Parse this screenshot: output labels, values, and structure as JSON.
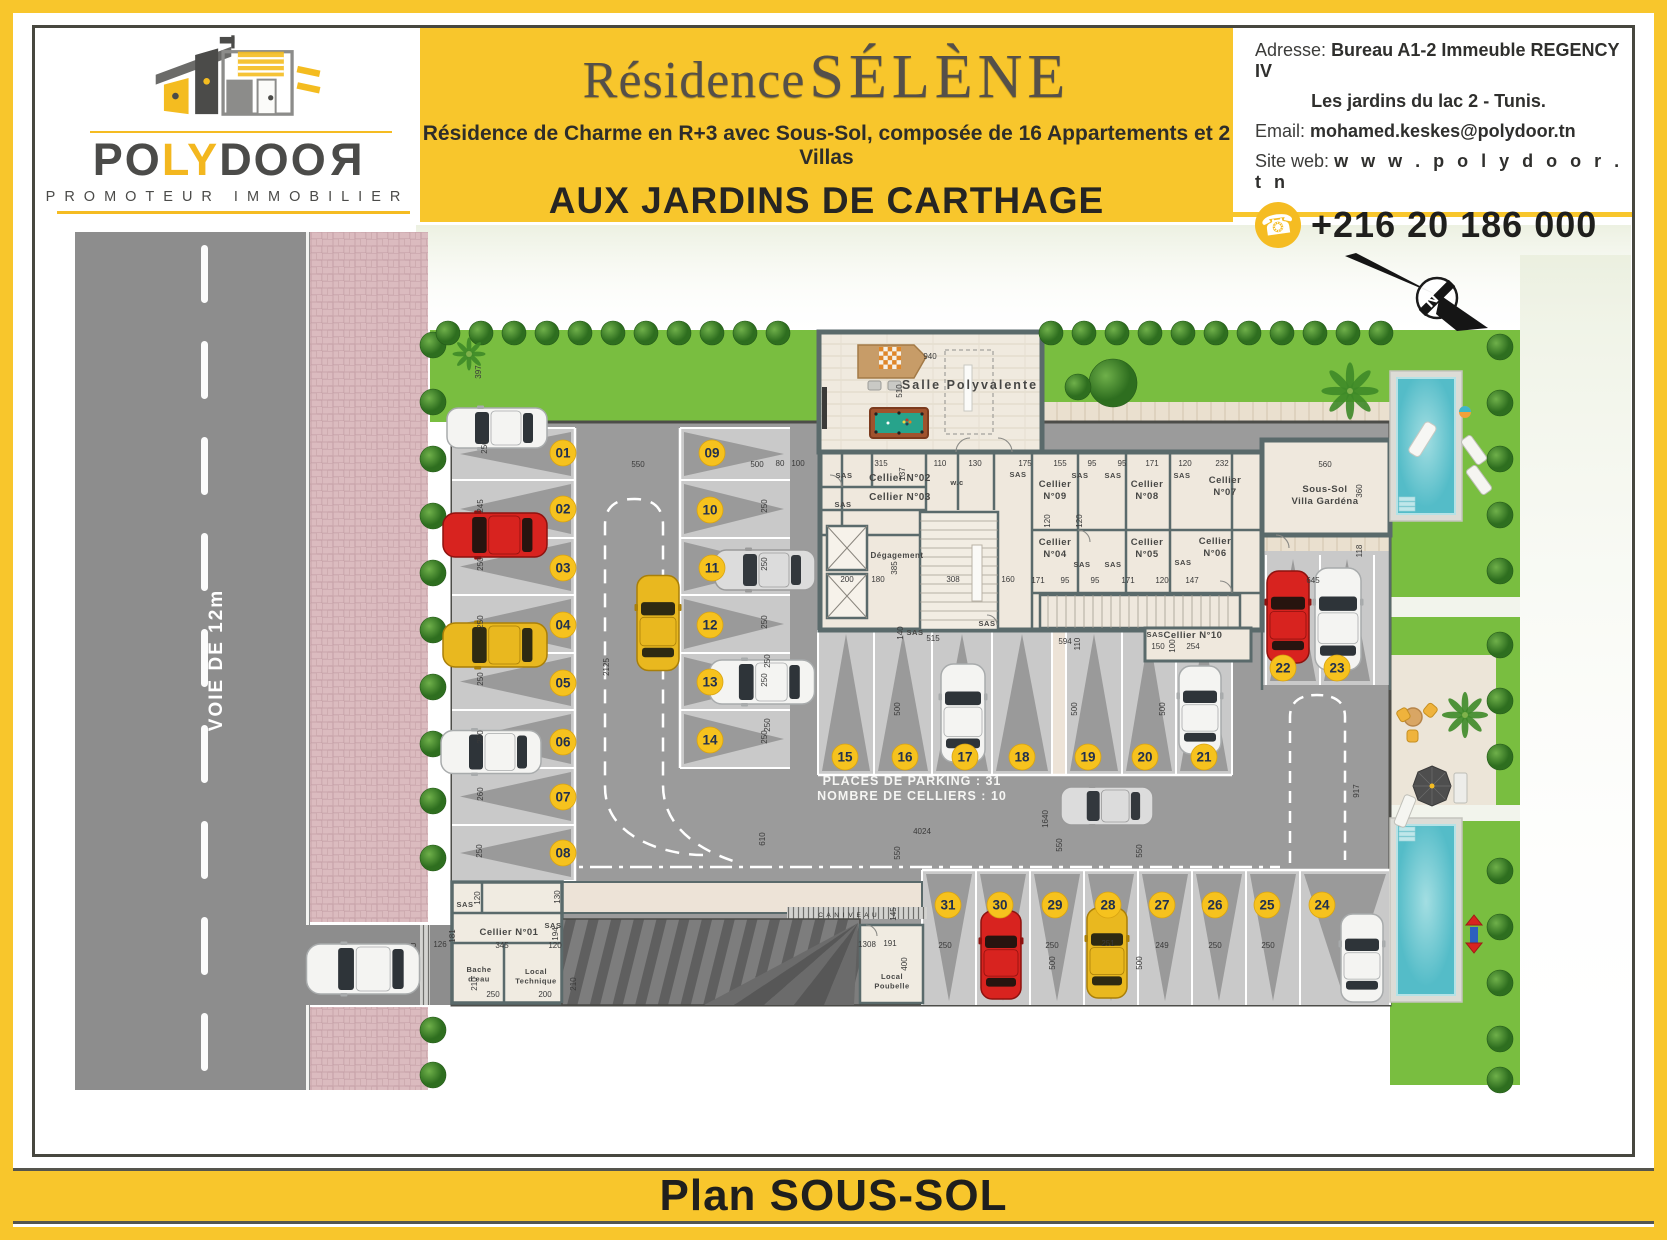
{
  "header": {
    "logo": {
      "brand_parts": [
        "PO",
        "LY",
        "DOO",
        "R"
      ],
      "tagline": "PROMOTEUR IMMOBILIER"
    },
    "title": {
      "line1": "Résidence",
      "line2": "SÉLÈNE"
    },
    "subtitle": "Résidence de Charme en R+3 avec Sous-Sol, composée de 16 Appartements et 2 Villas",
    "location": "AUX JARDINS DE CARTHAGE",
    "contact": {
      "address_label": "Adresse:",
      "address_value": "Bureau A1-2 Immeuble REGENCY IV",
      "address_line2": "Les jardins du lac 2 - Tunis.",
      "email_label": "Email:",
      "email_value": "mohamed.keskes@polydoor.tn",
      "web_label": "Site web:",
      "web_value": "w w w . p o l y d o o r . t n",
      "phone": "+216 20 186 000"
    }
  },
  "footer": {
    "title": "Plan SOUS-SOL"
  },
  "colors": {
    "yellow": "#F8C62C",
    "frame": "#47473F",
    "road": "#8D8D8D",
    "lane": "#9B9B9B",
    "stall": "#C9C9C9",
    "triangle": "#9A9A9A",
    "wall": "#5A6A6B",
    "floor": "#EFE8DD",
    "corridor": "#EDE3D7",
    "lawn": "#79BE40",
    "sidewalk": "#DBBBBF",
    "pool": "#5FC3CD",
    "badge": "#F6C21E",
    "badge_text": "#21304E",
    "deck": "#EAE0CF"
  },
  "car_colors": {
    "white": {
      "body": "#F4F4F2",
      "edge": "#A8ABAC",
      "glass": "#2E3439"
    },
    "red": {
      "body": "#D8231F",
      "edge": "#8E120F",
      "glass": "#27140F"
    },
    "yellow": {
      "body": "#E9B81F",
      "edge": "#A97F08",
      "glass": "#2E2A12"
    },
    "silver": {
      "body": "#DCDCDC",
      "edge": "#9A9A9A",
      "glass": "#33383D"
    }
  },
  "plan": {
    "road_label": "VOIE DE 12m",
    "canal_label": "CANIVEAU",
    "canal_letters": "C A N I V E A U",
    "stats": [
      "PLACES DE PARKING : 31",
      "NOMBRE DE CELLIERS : 10"
    ],
    "compass_letter": "N",
    "sas_text": "SAS",
    "spots": [
      [
        "01",
        527,
        228
      ],
      [
        "02",
        527,
        284
      ],
      [
        "03",
        527,
        343
      ],
      [
        "04",
        527,
        400
      ],
      [
        "05",
        527,
        458
      ],
      [
        "06",
        527,
        517
      ],
      [
        "07",
        527,
        572
      ],
      [
        "08",
        527,
        628
      ],
      [
        "09",
        676,
        228
      ],
      [
        "10",
        674,
        285
      ],
      [
        "11",
        676,
        343
      ],
      [
        "12",
        674,
        400
      ],
      [
        "13",
        674,
        457
      ],
      [
        "14",
        674,
        515
      ],
      [
        "15",
        809,
        532
      ],
      [
        "16",
        869,
        532
      ],
      [
        "17",
        929,
        532
      ],
      [
        "18",
        986,
        532
      ],
      [
        "19",
        1052,
        532
      ],
      [
        "20",
        1109,
        532
      ],
      [
        "21",
        1168,
        532
      ],
      [
        "22",
        1247,
        443
      ],
      [
        "23",
        1301,
        443
      ],
      [
        "24",
        1286,
        680
      ],
      [
        "25",
        1231,
        680
      ],
      [
        "26",
        1179,
        680
      ],
      [
        "27",
        1126,
        680
      ],
      [
        "28",
        1072,
        680
      ],
      [
        "29",
        1019,
        680
      ],
      [
        "30",
        964,
        680
      ],
      [
        "31",
        912,
        680
      ]
    ],
    "room_labels": [
      {
        "n": "salle-polyvalente",
        "l": [
          "Salle Polyvalente"
        ],
        "x": 934,
        "y": 164,
        "s": 12.5,
        "sp": 2
      },
      {
        "n": "cellier-02",
        "l": [
          "Cellier N°02"
        ],
        "x": 864,
        "y": 256,
        "s": 10
      },
      {
        "n": "cellier-03",
        "l": [
          "Cellier N°03"
        ],
        "x": 864,
        "y": 275,
        "s": 10
      },
      {
        "n": "wc",
        "l": [
          "w.c"
        ],
        "x": 921,
        "y": 260,
        "s": 7.5
      },
      {
        "n": "degagement",
        "l": [
          "Dégagement"
        ],
        "x": 861,
        "y": 333,
        "s": 8
      },
      {
        "n": "cellier-09",
        "l": [
          "Cellier",
          "N°09"
        ],
        "x": 1019,
        "y": 262,
        "s": 9.5
      },
      {
        "n": "cellier-08",
        "l": [
          "Cellier",
          "N°08"
        ],
        "x": 1111,
        "y": 262,
        "s": 9.5
      },
      {
        "n": "cellier-07",
        "l": [
          "Cellier",
          "N°07"
        ],
        "x": 1189,
        "y": 258,
        "s": 9.5
      },
      {
        "n": "cellier-04",
        "l": [
          "Cellier",
          "N°04"
        ],
        "x": 1019,
        "y": 320,
        "s": 9.5
      },
      {
        "n": "cellier-05",
        "l": [
          "Cellier",
          "N°05"
        ],
        "x": 1111,
        "y": 320,
        "s": 9.5
      },
      {
        "n": "cellier-06",
        "l": [
          "Cellier",
          "N°06"
        ],
        "x": 1179,
        "y": 319,
        "s": 9.5
      },
      {
        "n": "villa-gardena",
        "l": [
          "Sous-Sol",
          "Villa Gardéna"
        ],
        "x": 1289,
        "y": 267,
        "s": 9.5
      },
      {
        "n": "cellier-10",
        "l": [
          "Cellier N°10"
        ],
        "x": 1157,
        "y": 413,
        "s": 9.5
      },
      {
        "n": "cellier-01",
        "l": [
          "Cellier N°01"
        ],
        "x": 473,
        "y": 710,
        "s": 9.5
      },
      {
        "n": "bache-eau",
        "l": [
          "Bache",
          "d'eau"
        ],
        "x": 443,
        "y": 747,
        "s": 7.5
      },
      {
        "n": "local-technique",
        "l": [
          "Local",
          "Technique"
        ],
        "x": 500,
        "y": 749,
        "s": 7.5
      },
      {
        "n": "local-poubelle",
        "l": [
          "Local",
          "Poubelle"
        ],
        "x": 856,
        "y": 754,
        "s": 7.5
      }
    ],
    "sas_positions": [
      [
        808,
        253
      ],
      [
        807,
        282
      ],
      [
        982,
        252
      ],
      [
        1044,
        253
      ],
      [
        1077,
        253
      ],
      [
        1146,
        253
      ],
      [
        1046,
        342
      ],
      [
        1077,
        342
      ],
      [
        1147,
        340
      ],
      [
        879,
        410
      ],
      [
        1119,
        412
      ],
      [
        951,
        401
      ],
      [
        429,
        682
      ],
      [
        517,
        703
      ]
    ],
    "dims": [
      [
        "397",
        445,
        147,
        -90
      ],
      [
        "250",
        451,
        222,
        -90
      ],
      [
        "245",
        447,
        281,
        -90
      ],
      [
        "250",
        447,
        339,
        -90
      ],
      [
        "250",
        447,
        397,
        -90
      ],
      [
        "250",
        447,
        454,
        -90
      ],
      [
        "250",
        447,
        512,
        -90
      ],
      [
        "260",
        447,
        569,
        -90
      ],
      [
        "250",
        446,
        626,
        -90
      ],
      [
        "2125",
        573,
        442,
        -90
      ],
      [
        "550",
        602,
        242,
        0
      ],
      [
        "500",
        721,
        242,
        0
      ],
      [
        "250",
        731,
        281,
        -90
      ],
      [
        "250",
        731,
        339,
        -90
      ],
      [
        "250",
        731,
        397,
        -90
      ],
      [
        "250",
        731,
        455,
        -90
      ],
      [
        "250",
        731,
        512,
        -90
      ],
      [
        "940",
        894,
        134,
        0
      ],
      [
        "510",
        866,
        166,
        -90
      ],
      [
        "80",
        744,
        241,
        0
      ],
      [
        "100",
        762,
        241,
        0
      ],
      [
        "315",
        845,
        241,
        0
      ],
      [
        "137",
        869,
        249,
        -90
      ],
      [
        "110",
        904,
        241,
        0
      ],
      [
        "130",
        939,
        241,
        0
      ],
      [
        "175",
        989,
        241,
        0
      ],
      [
        "155",
        1024,
        241,
        0
      ],
      [
        "95",
        1056,
        241,
        0
      ],
      [
        "95",
        1086,
        241,
        0
      ],
      [
        "171",
        1116,
        241,
        0
      ],
      [
        "120",
        1149,
        241,
        0
      ],
      [
        "232",
        1186,
        241,
        0
      ],
      [
        "560",
        1289,
        242,
        0
      ],
      [
        "360",
        1326,
        266,
        -90
      ],
      [
        "118",
        1326,
        326,
        -90
      ],
      [
        "645",
        1277,
        358,
        0
      ],
      [
        "200",
        811,
        357,
        0
      ],
      [
        "180",
        842,
        357,
        0
      ],
      [
        "385",
        861,
        343,
        -90
      ],
      [
        "308",
        917,
        357,
        0
      ],
      [
        "160",
        972,
        357,
        0
      ],
      [
        "120",
        1014,
        296,
        -90
      ],
      [
        "120",
        1046,
        296,
        -90
      ],
      [
        "171",
        1002,
        358,
        0
      ],
      [
        "95",
        1029,
        358,
        0
      ],
      [
        "95",
        1059,
        358,
        0
      ],
      [
        "171",
        1092,
        358,
        0
      ],
      [
        "120",
        1126,
        358,
        0
      ],
      [
        "147",
        1156,
        358,
        0
      ],
      [
        "140",
        867,
        408,
        -90
      ],
      [
        "515",
        897,
        416,
        0
      ],
      [
        "594",
        1029,
        419,
        0
      ],
      [
        "110",
        1044,
        419,
        -90
      ],
      [
        "150",
        1122,
        424,
        0
      ],
      [
        "100",
        1139,
        421,
        -90
      ],
      [
        "254",
        1157,
        424,
        0
      ],
      [
        "250",
        734,
        436,
        -90
      ],
      [
        "250",
        734,
        500,
        -90
      ],
      [
        "500",
        864,
        484,
        -90
      ],
      [
        "500",
        1041,
        484,
        -90
      ],
      [
        "500",
        1129,
        484,
        -90
      ],
      [
        "4024",
        886,
        609,
        0
      ],
      [
        "1640",
        1012,
        594,
        -90
      ],
      [
        "610",
        729,
        614,
        -90
      ],
      [
        "550",
        864,
        628,
        -90
      ],
      [
        "550",
        1026,
        620,
        -90
      ],
      [
        "550",
        1106,
        626,
        -90
      ],
      [
        "917",
        1323,
        566,
        -90
      ],
      [
        "126",
        404,
        722,
        0
      ],
      [
        "345",
        466,
        723,
        0
      ],
      [
        "120",
        519,
        723,
        0
      ],
      [
        "181",
        419,
        711,
        -90
      ],
      [
        "120",
        444,
        673,
        -90
      ],
      [
        "130",
        524,
        672,
        -90
      ],
      [
        "194",
        522,
        709,
        -90
      ],
      [
        "210",
        441,
        759,
        -90
      ],
      [
        "250",
        457,
        772,
        0
      ],
      [
        "210",
        540,
        759,
        -90
      ],
      [
        "200",
        509,
        772,
        0
      ],
      [
        "1308",
        831,
        722,
        0
      ],
      [
        "400",
        871,
        739,
        -90
      ],
      [
        "191",
        854,
        721,
        0
      ],
      [
        "145",
        860,
        689,
        -90
      ],
      [
        "250",
        909,
        723,
        0
      ],
      [
        "250",
        1016,
        723,
        0
      ],
      [
        "251",
        1072,
        721,
        0
      ],
      [
        "249",
        1126,
        723,
        0
      ],
      [
        "250",
        1179,
        723,
        0
      ],
      [
        "250",
        1232,
        723,
        0
      ],
      [
        "500",
        1019,
        738,
        -90
      ],
      [
        "500",
        1106,
        738,
        -90
      ]
    ],
    "cars": [
      [
        "white",
        461,
        203,
        0,
        100,
        40
      ],
      [
        "red",
        459,
        310,
        0,
        104,
        44
      ],
      [
        "yellow",
        459,
        420,
        0,
        104,
        44
      ],
      [
        "white",
        455,
        527,
        0,
        100,
        43
      ],
      [
        "yellow",
        622,
        398,
        90,
        95,
        42
      ],
      [
        "silver",
        729,
        345,
        0,
        100,
        40
      ],
      [
        "white",
        726,
        457,
        0,
        105,
        44
      ],
      [
        "white",
        927,
        488,
        90,
        98,
        44
      ],
      [
        "silver",
        1071,
        581,
        0,
        92,
        38
      ],
      [
        "white",
        1164,
        485,
        90,
        88,
        42
      ],
      [
        "red",
        1252,
        392,
        90,
        92,
        42
      ],
      [
        "white",
        1302,
        394,
        90,
        102,
        46
      ],
      [
        "red",
        965,
        730,
        90,
        88,
        40
      ],
      [
        "yellow",
        1071,
        728,
        90,
        90,
        40
      ],
      [
        "white",
        1326,
        733,
        90,
        88,
        42
      ],
      [
        "white",
        327,
        744,
        0,
        113,
        50
      ]
    ]
  }
}
